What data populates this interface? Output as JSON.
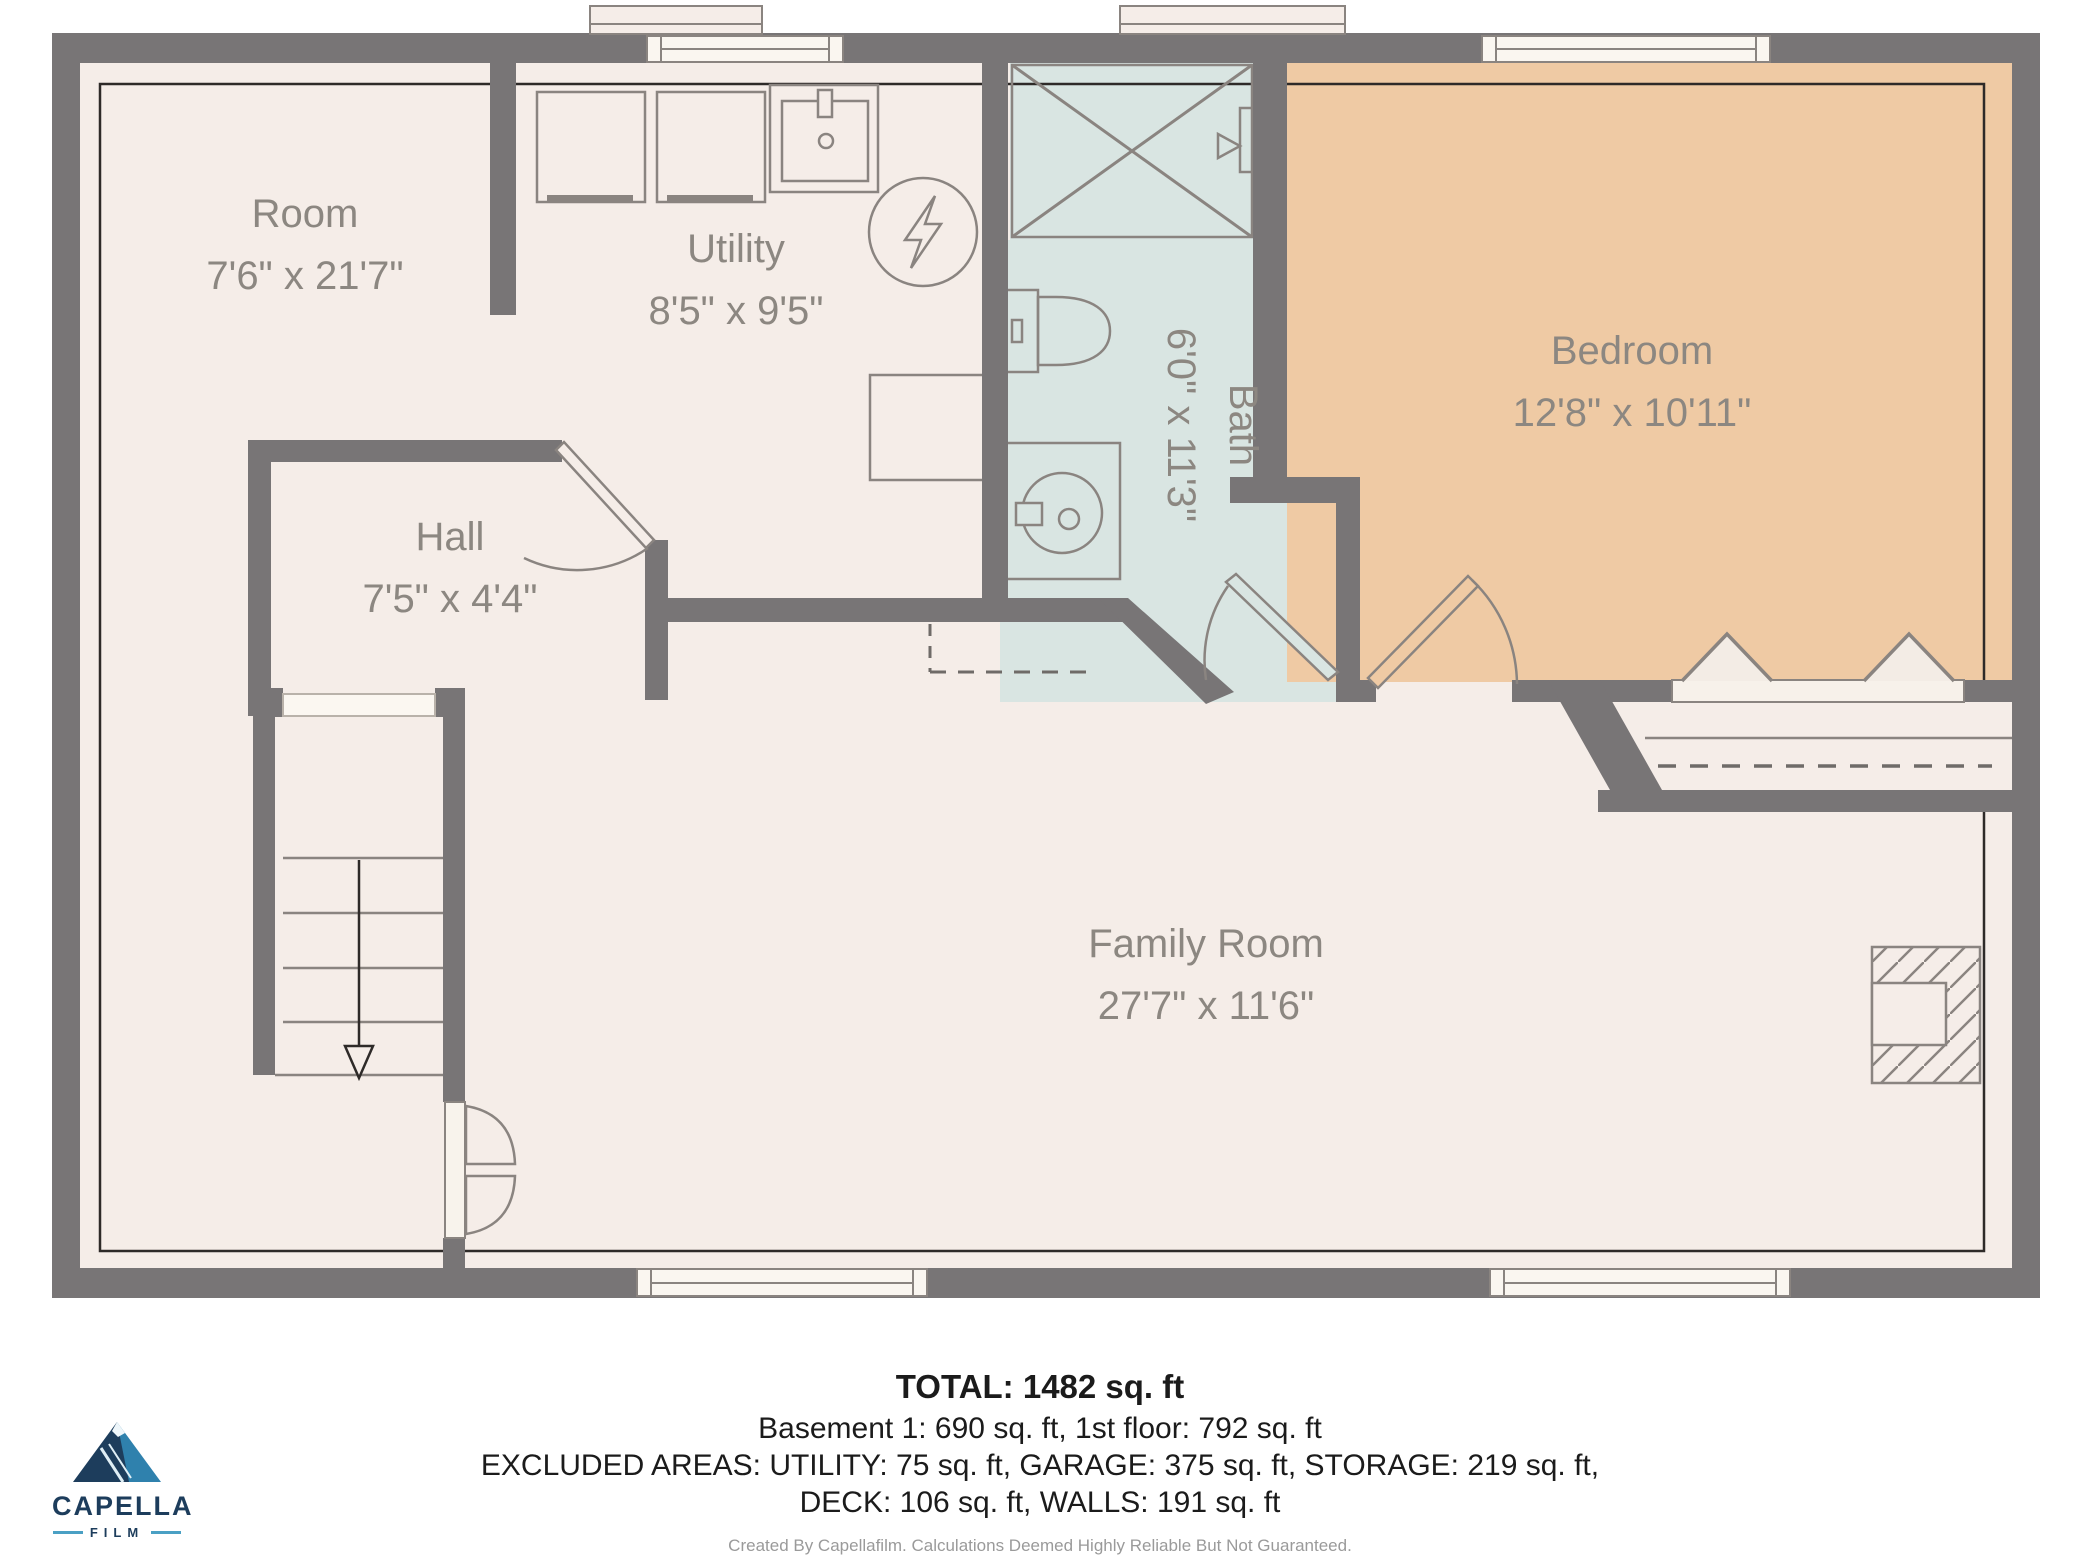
{
  "rooms": {
    "room": {
      "label": "Room",
      "dims": "7'6\" x 21'7\""
    },
    "utility": {
      "label": "Utility",
      "dims": "8'5\" x 9'5\""
    },
    "hall": {
      "label": "Hall",
      "dims": "7'5\" x 4'4\""
    },
    "bath": {
      "label": "Bath",
      "dims": "6'0\" x 11'3\""
    },
    "bedroom": {
      "label": "Bedroom",
      "dims": "12'8\" x 10'11\""
    },
    "family_room": {
      "label": "Family Room",
      "dims": "27'7\" x 11'6\""
    }
  },
  "summary": {
    "total": "TOTAL: 1482 sq. ft",
    "floors": "Basement 1: 690 sq. ft, 1st floor: 792 sq. ft",
    "excluded_1": "EXCLUDED AREAS: UTILITY: 75 sq. ft, GARAGE: 375 sq. ft, STORAGE: 219 sq. ft,",
    "excluded_2": "DECK: 106 sq. ft, WALLS: 191 sq. ft",
    "disclaimer": "Created By Capellafilm. Calculations Deemed Highly Reliable But Not Guaranteed."
  },
  "logo": {
    "brand": "CAPELLA",
    "sub": "FILM"
  },
  "colors": {
    "wall": "#787576",
    "floor": "#f5ede8",
    "bath": "#d9e5e2",
    "bedroom": "#efcaa4",
    "outline_thin": "#2e2a28",
    "fixture_stroke": "#8a8480",
    "label_text": "#8c8781",
    "logo_navy": "#1d3d5c",
    "logo_accent": "#4aa0c4"
  }
}
